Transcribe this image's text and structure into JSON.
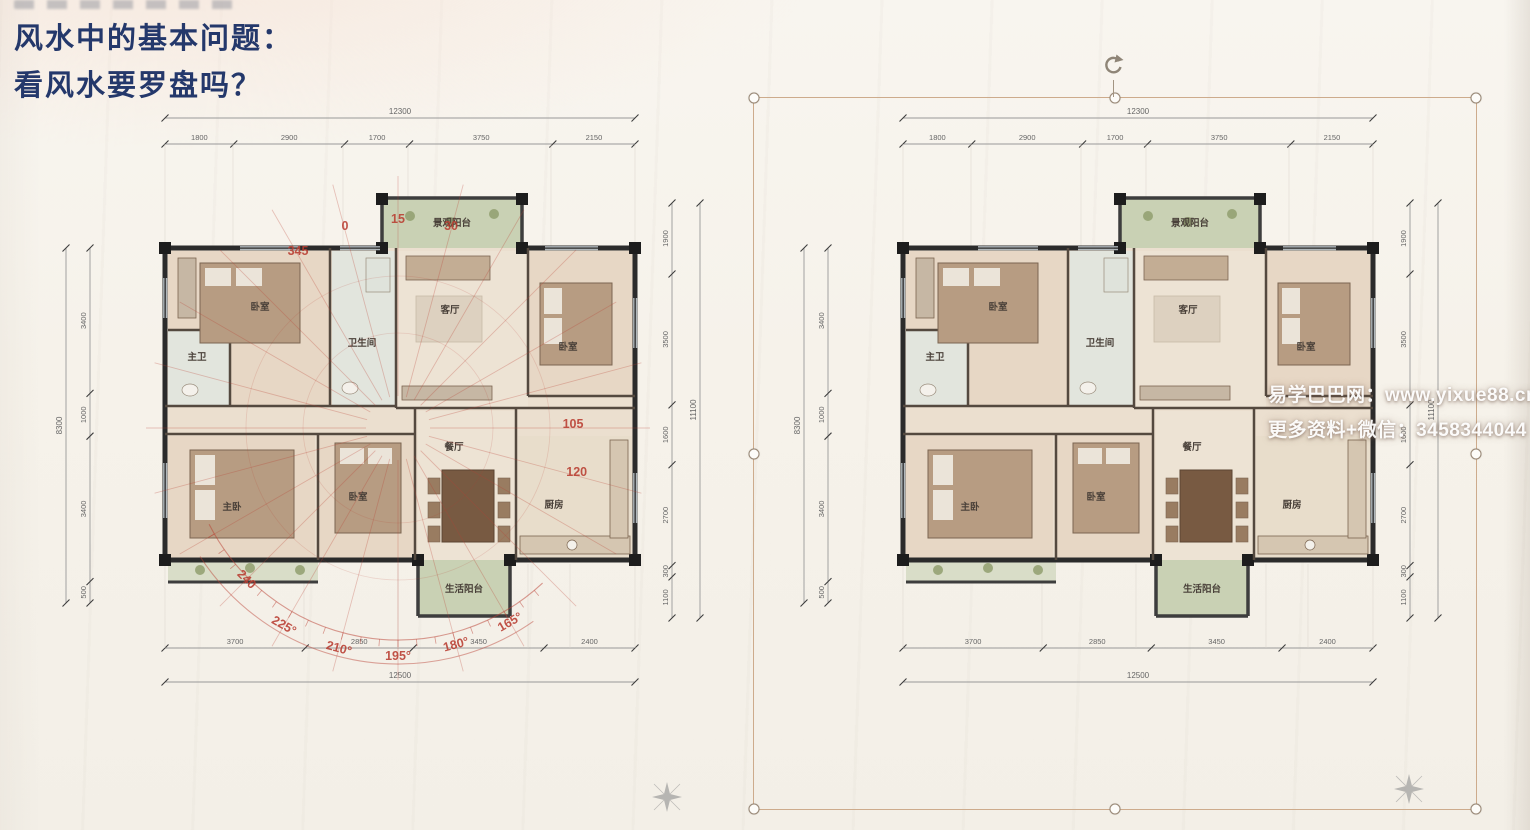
{
  "page": {
    "title_lines": [
      "风水中的基本问题：",
      "看风水要罗盘吗？"
    ],
    "title_color": "#24386b"
  },
  "watermark": {
    "site_line": "易学巴巴网：www.yixue88.cn",
    "contact_line": "更多资料+微信：3458344044"
  },
  "floor_plan": {
    "rooms": [
      {
        "label": "主卫"
      },
      {
        "label": "卧室"
      },
      {
        "label": "卫生间"
      },
      {
        "label": "客厅"
      },
      {
        "label": "景观阳台"
      },
      {
        "label": "卧室"
      },
      {
        "label": "主卧"
      },
      {
        "label": "卧室"
      },
      {
        "label": "餐厅"
      },
      {
        "label": "厨房"
      },
      {
        "label": "生活阳台"
      }
    ],
    "dimensions": {
      "top_total": "12300",
      "top_segments": [
        "1800",
        "2900",
        "1700",
        "3750",
        "2150"
      ],
      "bottom_segments": [
        "3700",
        "2850",
        "3450",
        "2400"
      ],
      "bottom_total": "12500",
      "left_segments": [
        "3400",
        "1000",
        "3400",
        "500"
      ],
      "left_total": "8300",
      "right_segments": [
        "1900",
        "3500",
        "1600",
        "2700",
        "300",
        "1100"
      ],
      "right_total": "11100"
    },
    "colors": {
      "wall": "#2b2b2b",
      "floor": "#ecdfcd",
      "bedroom_floor": "#e8d7c3",
      "bath_floor": "#e2e5dc",
      "balcony": "#c9d1b2",
      "furniture": "#b99c7f",
      "furniture_dark": "#7a5a40",
      "dim_line": "#999999",
      "dim_text": "#666666",
      "room_text": "#4a4038"
    }
  },
  "compass": {
    "color": "#c23b2e",
    "ring_rotation_deg": -15,
    "degree_labels": [
      {
        "text": "345",
        "deg": 345,
        "r": 200
      },
      {
        "text": "0",
        "deg": 0,
        "r": 205
      },
      {
        "text": "15",
        "deg": 15,
        "r": 205
      },
      {
        "text": "30",
        "deg": 30,
        "r": 205
      },
      {
        "text": "105",
        "deg": 105,
        "r": 175
      },
      {
        "text": "120",
        "deg": 120,
        "r": 185
      },
      {
        "text": "165°",
        "deg": 165,
        "r": 228
      },
      {
        "text": "180°",
        "deg": 180,
        "r": 228
      },
      {
        "text": "195°",
        "deg": 195,
        "r": 232
      },
      {
        "text": "210°",
        "deg": 210,
        "r": 232
      },
      {
        "text": "225°",
        "deg": 225,
        "r": 232
      },
      {
        "text": "240",
        "deg": 240,
        "r": 218
      }
    ]
  },
  "plans": [
    {
      "name": "floor-plan-with-compass",
      "has_compass": true,
      "selected": false
    },
    {
      "name": "floor-plan-clean",
      "has_compass": false,
      "selected": true
    }
  ],
  "icons": {
    "rotate_handle": "rotate-arrow",
    "north_arrow": "north-star-compass"
  }
}
